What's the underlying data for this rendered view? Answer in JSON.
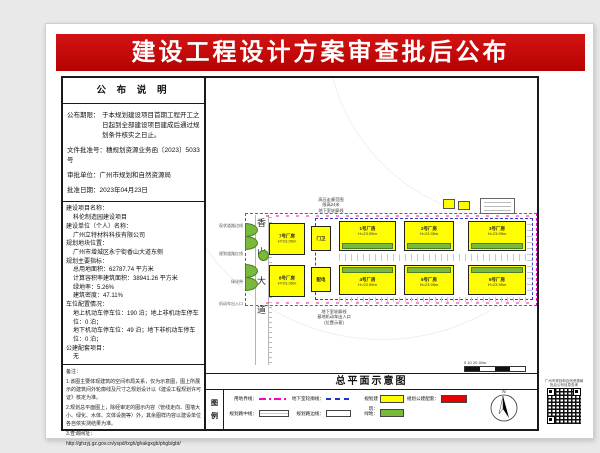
{
  "title": "建设工程设计方案审查批后公布",
  "notice": {
    "header": "公 布 说 明",
    "deadline_label": "公布期限：",
    "deadline_text": "于本规划建设项目首期工程开工之日起到全部建设项目建成后通过规划条件核实之日止。",
    "doc_no": "文件批准号：穗规划资源业务函〔2023〕5033 号",
    "authority": "审批单位：广州市规划和自然资源局",
    "date": "批准日期：2023年04月23日"
  },
  "project": {
    "name_label": "建设项目名称：",
    "name": "科伦制造园建设项目",
    "owner_label": "建设单位（个人）名称：",
    "owner": "广州立特材料科技有限公司",
    "location_label": "规划地块位置：",
    "location": "广州市增城区永宁街香山大道东侧",
    "indicators_label": "规划主要指标：",
    "land_area": "总用地面积：62787.74 平方米",
    "floor_area": "计算容积率建筑面积：38941.26 平方米",
    "green_rate": "绿地率：5.26%",
    "density": "建筑密度：47.11%",
    "parking_label": "车位配置情况：",
    "parking_ground": "地上机动车停车位：190 泊；地上非机动车停车位：0 泊；",
    "parking_underground": "地下机动车停车位：49 泊；地下非机动车停车位：0 泊；",
    "public_label": "公建配套项目：",
    "public_value": "无"
  },
  "remarks": {
    "header": "备注：",
    "item1": "1.该图主要体现建筑的空间布局关系，仅为示意图，图上所展示的建筑间外轮廓线及尺寸之规划设计以《建设工程规划许可证》核定为准。",
    "item2": "2.规划总平面图上，除经审定的图示内容（管线走向、围墙大小、绿化、水体、文体设施等）外，其余图样内容以建设单位各自依实测结果为准。",
    "item3": "3.查询网址：",
    "url": "http://ghzyj.gz.gov.cn/yspd/txgh/ghakgxgb/phgb/gbt/"
  },
  "plan": {
    "caption": "总平面示意图",
    "road_name": "香山大道",
    "north_label": "N",
    "scale_labels": "0   10   20   40m",
    "buildings": [
      {
        "name": "1号厂房",
        "sub": "H=23.95m"
      },
      {
        "name": "2号厂房",
        "sub": "H=23.95m"
      },
      {
        "name": "3号厂房",
        "sub": "H=23.95m"
      },
      {
        "name": "4号厂房",
        "sub": "H=23.95m"
      },
      {
        "name": "5号厂房",
        "sub": "H=23.95m"
      },
      {
        "name": "6号厂房",
        "sub": "H=23.95m"
      }
    ],
    "aux_buildings": [
      {
        "name": "7号厂房",
        "sub": "H=23.95m"
      },
      {
        "name": "8号厂房",
        "sub": "H=23.95m"
      },
      {
        "name": "门卫",
        "sub": ""
      },
      {
        "name": "配电",
        "sub": ""
      }
    ],
    "top_note": [
      "高压走廊范围",
      "限高24米",
      "地下室轮廓线"
    ],
    "bottom_note": [
      "地下室轮廓线",
      "基地机动车出入口",
      "(位置示意)"
    ],
    "side_notes": [
      "现状道路边线",
      "规划道路红线",
      "绿化带",
      "机动车出入口"
    ]
  },
  "legend": {
    "header_top": "图",
    "header_bottom": "例",
    "row1": [
      {
        "label": "用地界线："
      },
      {
        "label": "地下室轮廓线："
      },
      {
        "label": "规划建筑："
      },
      {
        "label": "规划公建配套："
      }
    ],
    "row2": [
      {
        "label": "规划路中线："
      },
      {
        "label": "规划路边线："
      },
      {
        "label": "绿地："
      }
    ]
  },
  "qr": {
    "caption_line1": "广州市规划和自然资源局",
    "caption_line2": "批后公布信息查询"
  },
  "colors": {
    "banner": "#c00000",
    "building": "#fefe00",
    "green": "#79b93c",
    "public": "#e60000",
    "boundary": "#ff00cc",
    "underground": "#3a3acc"
  }
}
